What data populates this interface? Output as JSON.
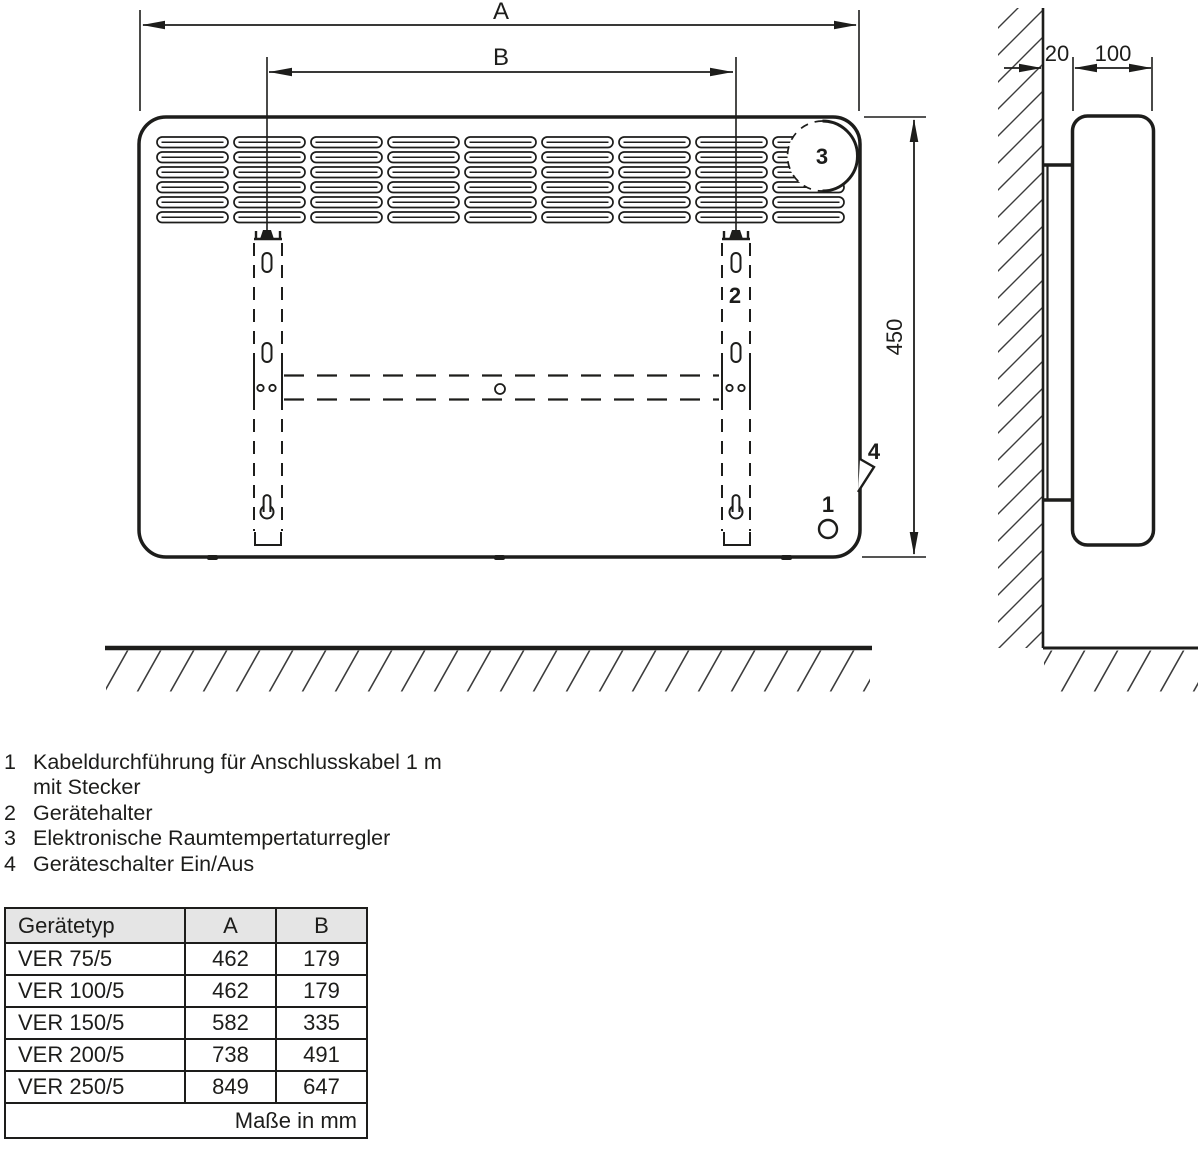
{
  "diagram": {
    "labels": {
      "width": "A",
      "bracket_distance": "B",
      "height": "450",
      "wall_gap": "20",
      "depth": "100"
    },
    "callouts": {
      "c1": "1",
      "c2": "2",
      "c3": "3",
      "c4": "4"
    },
    "line_color": "#1d1d1b"
  },
  "legend": {
    "items": [
      {
        "num": "1",
        "text": "Kabeldurchführung für Anschlusskabel 1 m",
        "text2": "mit Stecker"
      },
      {
        "num": "2",
        "text": "Gerätehalter"
      },
      {
        "num": "3",
        "text": "Elektronische Raumtempertaturregler"
      },
      {
        "num": "4",
        "text": "Geräteschalter Ein/Aus"
      }
    ]
  },
  "table": {
    "headers": [
      "Gerätetyp",
      "A",
      "B"
    ],
    "header_bg": "#e5e5e5",
    "rows": [
      {
        "type": "VER 75/5",
        "a": "462",
        "b": "179"
      },
      {
        "type": "VER 100/5",
        "a": "462",
        "b": "179"
      },
      {
        "type": "VER 150/5",
        "a": "582",
        "b": "335"
      },
      {
        "type": "VER 200/5",
        "a": "738",
        "b": "491"
      },
      {
        "type": "VER 250/5",
        "a": "849",
        "b": "647"
      }
    ],
    "footer": "Maße in mm"
  }
}
